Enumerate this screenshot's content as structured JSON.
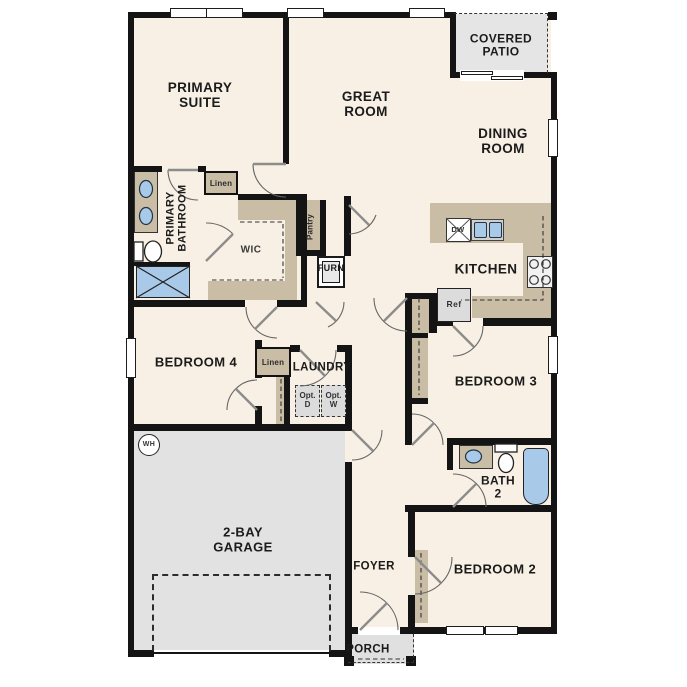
{
  "rooms": {
    "covered_patio": "COVERED\nPATIO",
    "primary_suite": "PRIMARY\nSUITE",
    "great_room": "GREAT\nROOM",
    "dining_room": "DINING\nROOM",
    "kitchen": "KITCHEN",
    "primary_bathroom": "PRIMARY\nBATHROOM",
    "wic": "WIC",
    "bedroom_4": "BEDROOM 4",
    "laundry": "LAUNDRY",
    "bedroom_3": "BEDROOM 3",
    "bath_2": "BATH\n2",
    "garage": "2-BAY\nGARAGE",
    "foyer": "FOYER",
    "bedroom_2": "BEDROOM 2",
    "porch": "PORCH"
  },
  "closets": {
    "linen_primary": "Linen",
    "linen_hall": "Linen",
    "pantry": "Pantry"
  },
  "equipment": {
    "dishwasher": "DW",
    "refrigerator": "Ref",
    "furnace": "FURN",
    "water_heater": "WH",
    "optional_dryer": "Opt.\nD",
    "optional_washer": "Opt.\nW"
  },
  "colors": {
    "floor": "#f8f0e5",
    "wall": "#141414",
    "cabinetry": "#c9bda6",
    "plumbing_blue": "#a9c9e9",
    "garage_floor": "#e2e2e2",
    "patio_floor": "#e5e5e5"
  }
}
